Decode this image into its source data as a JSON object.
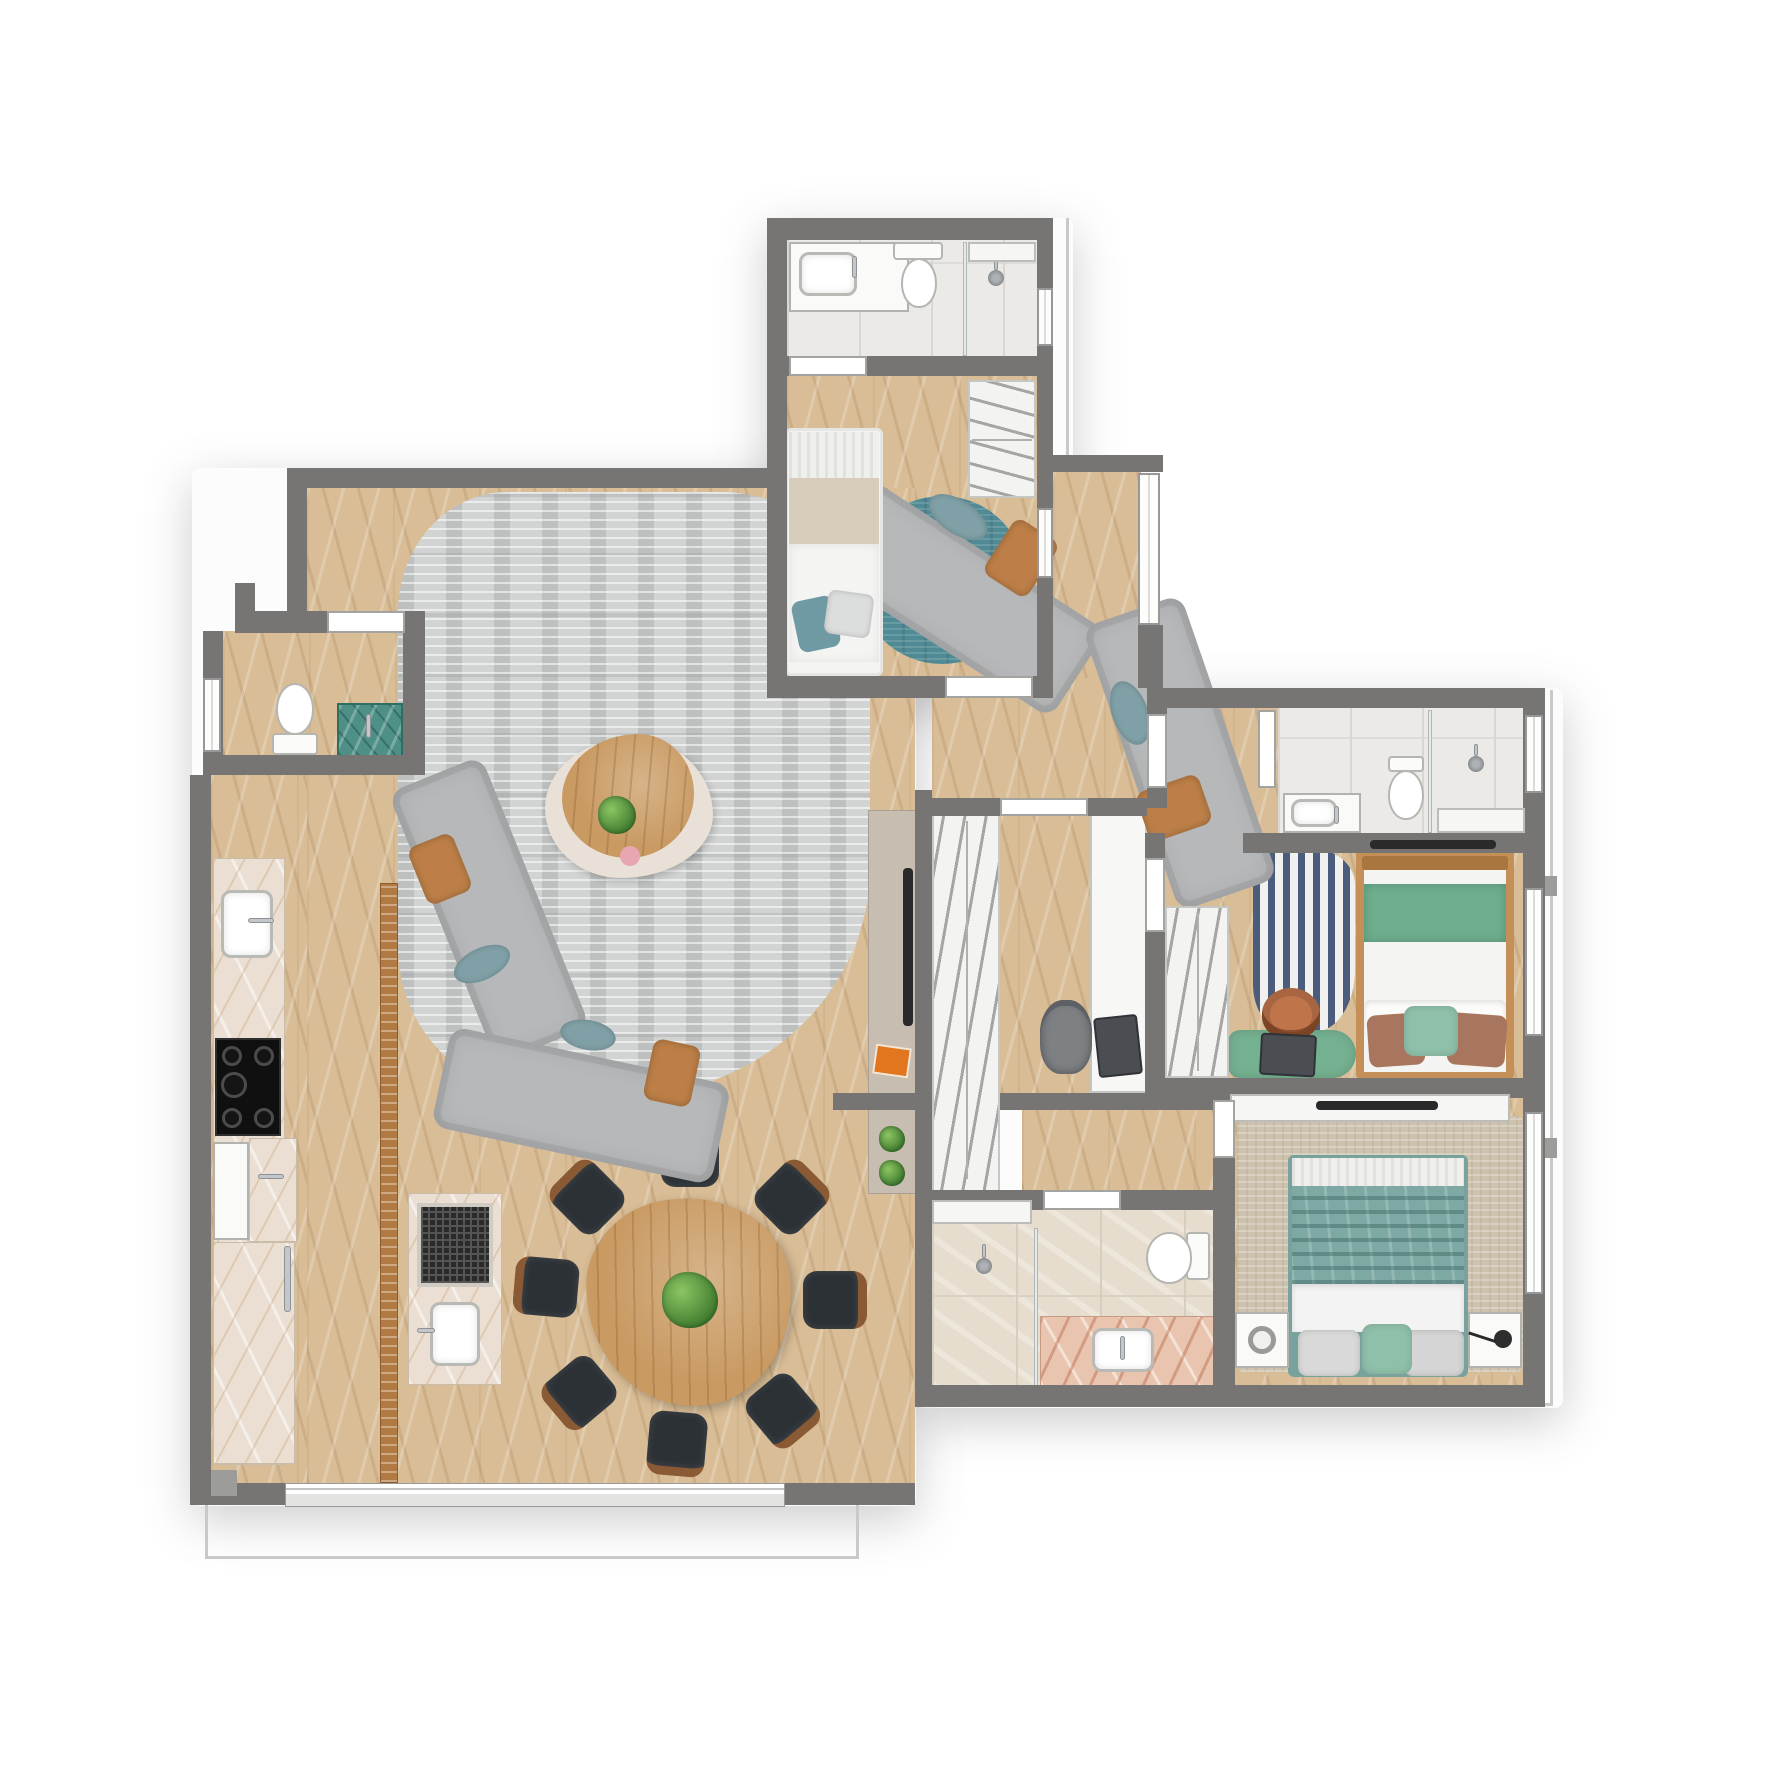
{
  "meta": {
    "kind": "furnished apartment floor plan, top-down render",
    "canvas_px": 1771,
    "visible_text": "none"
  },
  "palette": {
    "wall": "#767574",
    "slab_line": "#c9c9c7",
    "wood": "#d9bd96",
    "rug_living": "#d2d4d3",
    "rug_teal": "#4f8a95",
    "rug_master": "#cdc2ae",
    "stripe_navy": "#4c5c7c",
    "tile_light": "#ebeae7",
    "tile_beige": "#e6ddcf",
    "marble_kitchen": "#eadfd2",
    "marble_pink": "#e9c4ae",
    "white_fixture": "#fafaf8",
    "closet_bg": "#f3f3f1",
    "hanger": "#a5a5a3",
    "sofa": "#b7b8ba",
    "pillow_tan": "#bd7f47",
    "pillow_teal": "#7fa0a6",
    "wood_furniture": "#c99a62",
    "chair_seat": "#2c3136",
    "chair_wood": "#8a5a34",
    "terracotta": "#c0744a",
    "console": "#c7beb1",
    "book_orange": "#e2761f",
    "plant_dark": "#3e7a2e",
    "laptop": "#4a4d52",
    "green_furniture": "#74b190",
    "green_bed": "#6fae8e",
    "green_cabinet": "#4e8f86",
    "teal_blanket": "#7da8a3",
    "bed_wood": "#c49058",
    "lamp_black": "#2a2a2a"
  },
  "rooms": [
    {
      "id": "bathroom-top",
      "floor": "light gray tile",
      "fixtures": [
        "sink counter",
        "toilet",
        "shower with glass divider",
        "wall niche",
        "window"
      ]
    },
    {
      "id": "small-bedroom",
      "floor": "chevron wood",
      "fixtures": [
        "single bed with teal pillows",
        "round teal rug",
        "hanger wardrobe",
        "window"
      ]
    },
    {
      "id": "entry-foyer",
      "floor": "chevron wood",
      "fixtures": [
        "full-height windows"
      ]
    },
    {
      "id": "living-room",
      "floor": "chevron wood",
      "fixtures": [
        "two angled gray sofas",
        "organic gray rug",
        "pebble coffee table",
        "tv sideboard",
        "wall tv",
        "wood slat divider"
      ]
    },
    {
      "id": "powder-room",
      "floor": "chevron wood",
      "fixtures": [
        "toilet",
        "green marble washbasin",
        "window"
      ]
    },
    {
      "id": "kitchen",
      "floor": "chevron wood",
      "fixtures": [
        "marble counter",
        "sink",
        "5-burner cooktop",
        "oven front",
        "tall cabinet with chrome handle"
      ]
    },
    {
      "id": "dining-area",
      "floor": "chevron wood",
      "fixtures": [
        "rounded triangular wood table",
        "8 black chairs",
        "center plant",
        "island with grill and sink"
      ]
    },
    {
      "id": "office-closet-hall",
      "floor": "chevron wood",
      "fixtures": [
        "long hanger closet",
        "white desk with laptop",
        "office chair"
      ]
    },
    {
      "id": "suite-bathroom",
      "floor": "light gray tile",
      "fixtures": [
        "sink counter",
        "toilet",
        "shower with glass divider",
        "niche",
        "window"
      ]
    },
    {
      "id": "green-bedroom",
      "floor": "chevron wood",
      "fixtures": [
        "double bed green bedding",
        "striped navy rug",
        "green desk bench with laptop",
        "terracotta chair",
        "hanger wardrobe",
        "wall tv",
        "window"
      ]
    },
    {
      "id": "corridor",
      "floor": "chevron wood",
      "fixtures": []
    },
    {
      "id": "master-bathroom",
      "floor": "travertine tile",
      "fixtures": [
        "shower",
        "glass divider",
        "pink marble sink counter",
        "toilet",
        "shelf"
      ]
    },
    {
      "id": "master-bedroom",
      "floor": "chevron wood + beige rug",
      "fixtures": [
        "double bed teal blanket",
        "two nightstands",
        "round lamp",
        "black arc lamp",
        "tv shelf with tv",
        "windows"
      ]
    }
  ],
  "notes": {
    "doors": "white threshold slabs in wall openings",
    "exterior": "thin light-gray slab outline at lower-left balcony and right edge"
  }
}
